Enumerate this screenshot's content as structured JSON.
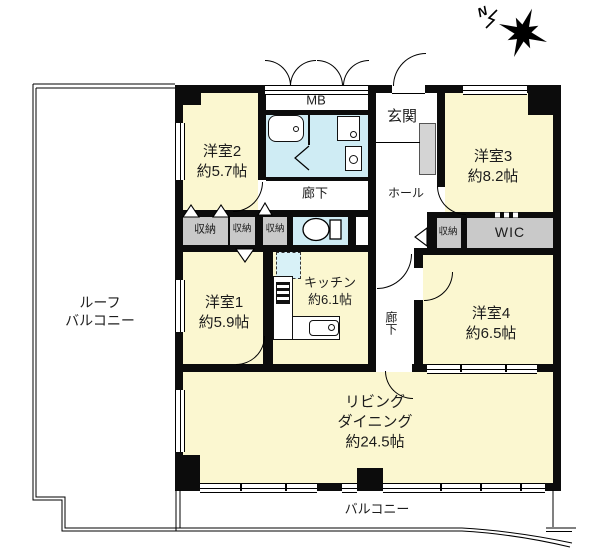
{
  "compass": {
    "north": "N"
  },
  "rooms": {
    "bedroom2": {
      "name": "洋室2",
      "size": "約5.7帖"
    },
    "bedroom3": {
      "name": "洋室3",
      "size": "約8.2帖"
    },
    "bedroom1": {
      "name": "洋室1",
      "size": "約5.9帖"
    },
    "bedroom4": {
      "name": "洋室4",
      "size": "約6.5帖"
    },
    "kitchen": {
      "name": "キッチン",
      "size": "約6.1帖"
    },
    "living_dining": {
      "line1": "リビング",
      "line2": "ダイニング",
      "size": "約24.5帖"
    },
    "entrance": {
      "name": "玄関"
    },
    "hall": {
      "name": "ホール"
    },
    "corridor_upper": {
      "name": "廊下"
    },
    "corridor_side": {
      "name": "廊下"
    },
    "roof_balcony": {
      "line1": "ルーフ",
      "line2": "バルコニー"
    },
    "balcony": {
      "name": "バルコニー"
    }
  },
  "labels": {
    "mb": "MB",
    "wic": "WIC",
    "storage": "収納"
  },
  "colors": {
    "room_yellow": "#FBF7D0",
    "wet_area_blue": "#CFECF4",
    "storage_gray": "#C9C9C9",
    "wall_black": "#0C0C0C"
  }
}
